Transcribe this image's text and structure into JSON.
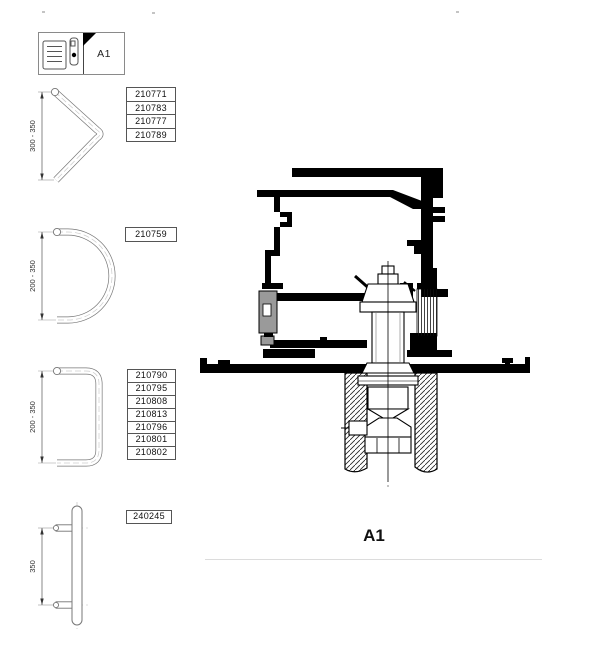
{
  "legend": {
    "label": "A1"
  },
  "handles": [
    {
      "shape": "v-shaped-pull-handle",
      "dimension": "300 - 350",
      "part_numbers": [
        "210771",
        "210783",
        "210777",
        "210789"
      ]
    },
    {
      "shape": "semicircular-pull-handle",
      "dimension": "200 - 350",
      "part_numbers": [
        "210759"
      ]
    },
    {
      "shape": "d-shaped-pull-handle",
      "dimension": "200 - 350",
      "part_numbers": [
        "210790",
        "210795",
        "210808",
        "210813",
        "210796",
        "210801",
        "210802"
      ]
    },
    {
      "shape": "straight-pull-handle",
      "dimension": "350",
      "part_numbers": [
        "240245"
      ]
    }
  ],
  "section": {
    "label": "A1"
  },
  "colors": {
    "line": "#000000",
    "handle_outline": "#777777",
    "gasket_gray": "#9a9a9a",
    "divider_line": "#dcdcdc"
  },
  "icons": [
    "louver-icon",
    "handle-profile-icon",
    "corner-triangle-icon"
  ]
}
